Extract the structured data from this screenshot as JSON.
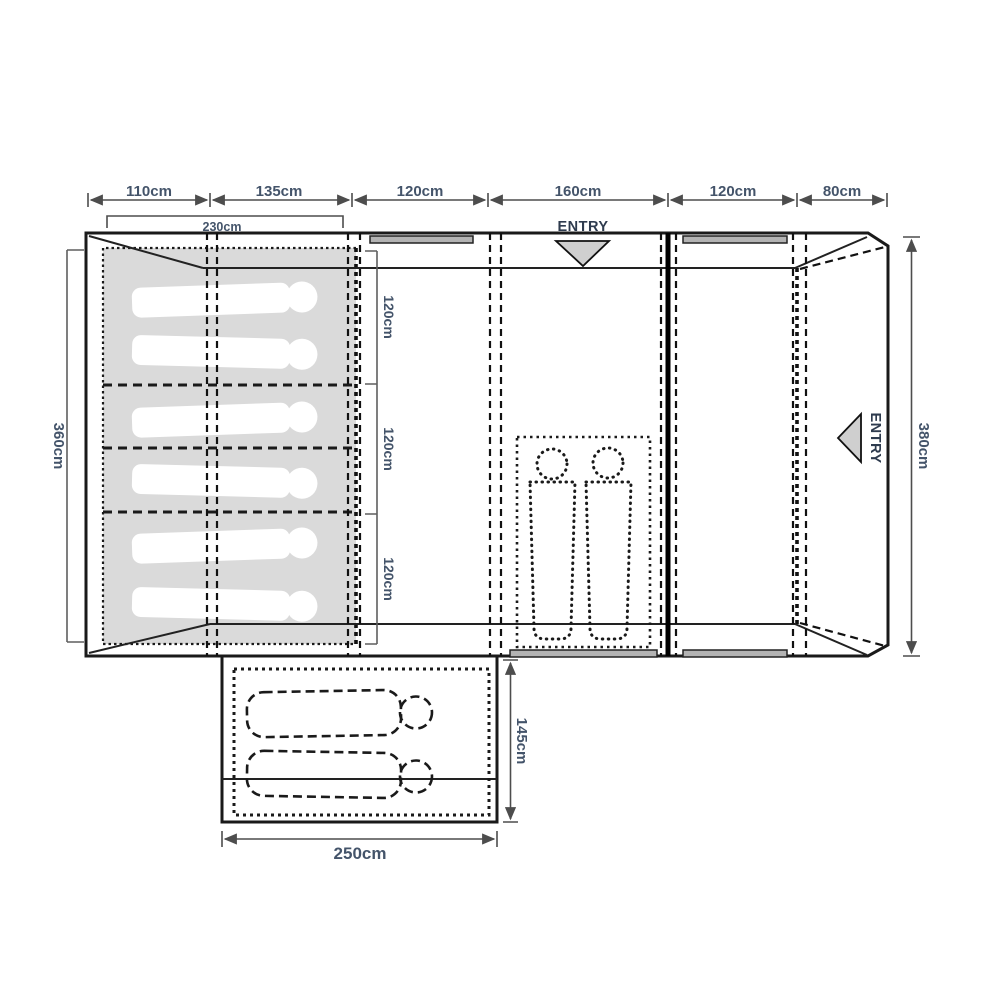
{
  "floorplan": {
    "type": "tent-floorplan-top-view",
    "unit": "cm",
    "top_dimensions": [
      "110cm",
      "135cm",
      "120cm",
      "160cm",
      "120cm",
      "80cm"
    ],
    "inner_bedroom_width": "230cm",
    "left_depth": "360cm",
    "right_depth": "380cm",
    "bedroom_bays": [
      "120cm",
      "120cm",
      "120cm"
    ],
    "front_entry_label": "ENTRY",
    "side_entry_label": "ENTRY",
    "annex": {
      "width": "250cm",
      "depth": "145cm"
    },
    "berths": {
      "bedroom_sleeping_bags": 6,
      "living_area_sleeping_bags": 2,
      "annex_sleeping_bags": 2
    },
    "colors": {
      "outline": "#1a1a1a",
      "dimension_line": "#4d4d4d",
      "label_text": "#44546a",
      "bedroom_fill": "#dadada",
      "sleeping_bag_fill": "#ffffff",
      "window_fill": "#b3b3b3",
      "entry_triangle_fill": "#cfcfcf",
      "background": "#ffffff"
    }
  }
}
